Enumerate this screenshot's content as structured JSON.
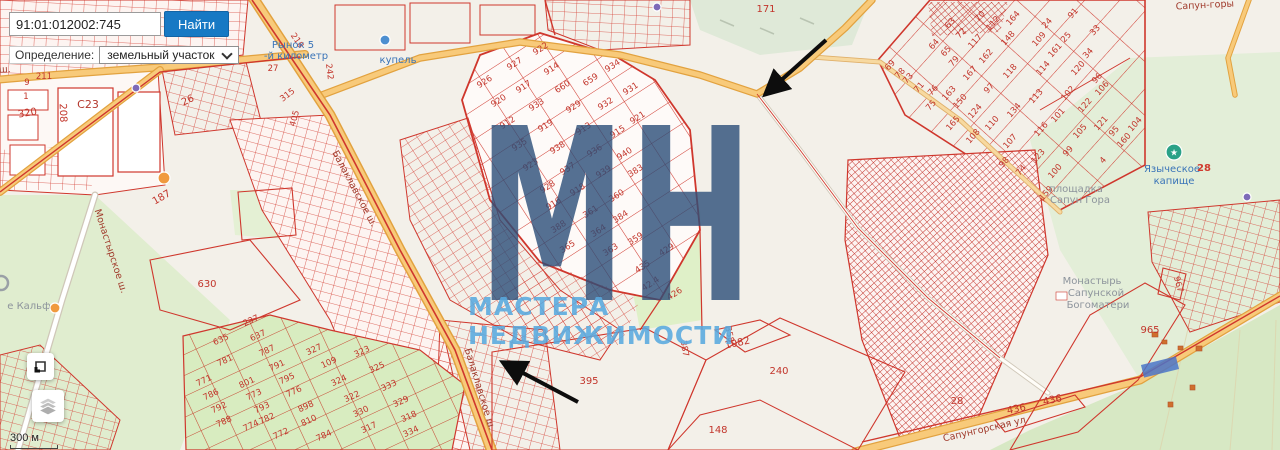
{
  "search": {
    "value": "91:01:012002:745",
    "button_label": "Найти"
  },
  "filter": {
    "label": "Определение:",
    "value": "земельный участок"
  },
  "annotations": {
    "area_label": "10.1 сот.",
    "domino_label": "«Домино»"
  },
  "watermark": {
    "big": "МН",
    "subtitle": "МАСТЕРА НЕДВИЖИМОСТИ"
  },
  "scale_label": "300 м",
  "theme": {
    "accent_blue": "#1779c4",
    "parcel_red": "#d1342c",
    "road_orange": "#f6c87c",
    "green": "#d9ecc0",
    "watermark_blue": "#2a4e78",
    "watermark_light_blue": "#58a8de"
  },
  "map": {
    "parcel_labels": [
      {
        "t": "9",
        "x": 27,
        "y": 85
      },
      {
        "t": "211",
        "x": 44,
        "y": 79
      },
      {
        "t": "1",
        "x": 26,
        "y": 99
      },
      {
        "t": "320",
        "x": 28,
        "y": 116,
        "r": -10,
        "c": "num-lg"
      },
      {
        "t": "208",
        "x": 60,
        "y": 113,
        "r": 88,
        "c": "num-lg"
      },
      {
        "t": "С23",
        "x": 88,
        "y": 108,
        "c": "num-xl"
      },
      {
        "t": "26",
        "x": 189,
        "y": 103,
        "r": -25,
        "c": "num-lg"
      },
      {
        "t": "218",
        "x": 295,
        "y": 42,
        "r": 55
      },
      {
        "t": "242",
        "x": 327,
        "y": 72,
        "r": 83
      },
      {
        "t": "27",
        "x": 273,
        "y": 71
      },
      {
        "t": "315",
        "x": 289,
        "y": 97,
        "r": -38
      },
      {
        "t": "405",
        "x": 297,
        "y": 119,
        "r": -75
      },
      {
        "t": "187",
        "x": 163,
        "y": 200,
        "r": -30,
        "c": "num-lg"
      },
      {
        "t": "630",
        "x": 207,
        "y": 287,
        "c": "num-lg"
      },
      {
        "t": "171",
        "x": 766,
        "y": 12,
        "c": "num-lg"
      },
      {
        "t": "922",
        "x": 542,
        "y": 51,
        "r": -33
      },
      {
        "t": "927",
        "x": 516,
        "y": 66,
        "r": -33
      },
      {
        "t": "914",
        "x": 553,
        "y": 71,
        "r": -33
      },
      {
        "t": "926",
        "x": 486,
        "y": 84,
        "r": -33
      },
      {
        "t": "917",
        "x": 525,
        "y": 89,
        "r": -33
      },
      {
        "t": "660",
        "x": 564,
        "y": 89,
        "r": -33
      },
      {
        "t": "934",
        "x": 614,
        "y": 68,
        "r": -33
      },
      {
        "t": "659",
        "x": 592,
        "y": 82,
        "r": -33
      },
      {
        "t": "931",
        "x": 632,
        "y": 91,
        "r": -33
      },
      {
        "t": "920",
        "x": 500,
        "y": 103,
        "r": -33
      },
      {
        "t": "933",
        "x": 538,
        "y": 107,
        "r": -33
      },
      {
        "t": "929",
        "x": 575,
        "y": 109,
        "r": -33
      },
      {
        "t": "932",
        "x": 607,
        "y": 106,
        "r": -33
      },
      {
        "t": "912",
        "x": 509,
        "y": 125,
        "r": -33
      },
      {
        "t": "919",
        "x": 547,
        "y": 128,
        "r": -33
      },
      {
        "t": "913",
        "x": 585,
        "y": 131,
        "r": -33
      },
      {
        "t": "921",
        "x": 639,
        "y": 120,
        "r": -33
      },
      {
        "t": "915",
        "x": 619,
        "y": 134,
        "r": -33
      },
      {
        "t": "935",
        "x": 521,
        "y": 147,
        "r": -33
      },
      {
        "t": "938",
        "x": 559,
        "y": 150,
        "r": -33
      },
      {
        "t": "936",
        "x": 596,
        "y": 153,
        "r": -33
      },
      {
        "t": "940",
        "x": 626,
        "y": 156,
        "r": -33
      },
      {
        "t": "923",
        "x": 532,
        "y": 167,
        "r": -33
      },
      {
        "t": "937",
        "x": 569,
        "y": 171,
        "r": -33
      },
      {
        "t": "939",
        "x": 605,
        "y": 174,
        "r": -33
      },
      {
        "t": "383",
        "x": 637,
        "y": 173,
        "r": -33
      },
      {
        "t": "928",
        "x": 549,
        "y": 189,
        "r": -33
      },
      {
        "t": "918",
        "x": 579,
        "y": 192,
        "r": -33
      },
      {
        "t": "916",
        "x": 555,
        "y": 206,
        "r": -33
      },
      {
        "t": "360",
        "x": 618,
        "y": 198,
        "r": -33
      },
      {
        "t": "361",
        "x": 592,
        "y": 214,
        "r": -33
      },
      {
        "t": "384",
        "x": 622,
        "y": 219,
        "r": -33
      },
      {
        "t": "364",
        "x": 600,
        "y": 233,
        "r": -33
      },
      {
        "t": "388",
        "x": 560,
        "y": 229,
        "r": -33
      },
      {
        "t": "365",
        "x": 569,
        "y": 249,
        "r": -33
      },
      {
        "t": "363",
        "x": 612,
        "y": 252,
        "r": -33
      },
      {
        "t": "359",
        "x": 637,
        "y": 241,
        "r": -33
      },
      {
        "t": "429",
        "x": 668,
        "y": 252,
        "r": -33
      },
      {
        "t": "435",
        "x": 644,
        "y": 269,
        "r": -33
      },
      {
        "t": "42.4",
        "x": 652,
        "y": 286,
        "r": -33
      },
      {
        "t": "426",
        "x": 676,
        "y": 296,
        "r": -33
      },
      {
        "t": "635",
        "x": 222,
        "y": 342,
        "r": -25
      },
      {
        "t": "637",
        "x": 259,
        "y": 338,
        "r": -25
      },
      {
        "t": "237",
        "x": 252,
        "y": 323,
        "r": -25
      },
      {
        "t": "781",
        "x": 226,
        "y": 363,
        "r": -25
      },
      {
        "t": "787",
        "x": 268,
        "y": 353,
        "r": -25
      },
      {
        "t": "791",
        "x": 278,
        "y": 368,
        "r": -25
      },
      {
        "t": "327",
        "x": 315,
        "y": 352,
        "r": -25
      },
      {
        "t": "323",
        "x": 363,
        "y": 354,
        "r": -25
      },
      {
        "t": "771",
        "x": 205,
        "y": 383,
        "r": -25
      },
      {
        "t": "786",
        "x": 212,
        "y": 397,
        "r": -25
      },
      {
        "t": "801",
        "x": 248,
        "y": 385,
        "r": -25
      },
      {
        "t": "795",
        "x": 288,
        "y": 381,
        "r": -25
      },
      {
        "t": "109",
        "x": 330,
        "y": 365,
        "r": -25
      },
      {
        "t": "325",
        "x": 378,
        "y": 370,
        "r": -25
      },
      {
        "t": "773",
        "x": 255,
        "y": 397,
        "r": -25
      },
      {
        "t": "776",
        "x": 295,
        "y": 394,
        "r": -25
      },
      {
        "t": "324",
        "x": 340,
        "y": 383,
        "r": -25
      },
      {
        "t": "333",
        "x": 390,
        "y": 388,
        "r": -25
      },
      {
        "t": "792",
        "x": 220,
        "y": 410,
        "r": -25
      },
      {
        "t": "793",
        "x": 263,
        "y": 410,
        "r": -25
      },
      {
        "t": "898",
        "x": 307,
        "y": 409,
        "r": -25
      },
      {
        "t": "322",
        "x": 353,
        "y": 399,
        "r": -25
      },
      {
        "t": "329",
        "x": 402,
        "y": 404,
        "r": -25
      },
      {
        "t": "788",
        "x": 225,
        "y": 424,
        "r": -25
      },
      {
        "t": "774",
        "x": 252,
        "y": 428,
        "r": -25
      },
      {
        "t": "782",
        "x": 268,
        "y": 421,
        "r": -25
      },
      {
        "t": "810",
        "x": 310,
        "y": 423,
        "r": -25
      },
      {
        "t": "330",
        "x": 362,
        "y": 414,
        "r": -25
      },
      {
        "t": "318",
        "x": 410,
        "y": 419,
        "r": -25
      },
      {
        "t": "772",
        "x": 282,
        "y": 436,
        "r": -25
      },
      {
        "t": "784",
        "x": 325,
        "y": 438,
        "r": -25
      },
      {
        "t": "317",
        "x": 370,
        "y": 430,
        "r": -25
      },
      {
        "t": "334",
        "x": 412,
        "y": 434,
        "r": -25
      },
      {
        "t": "69",
        "x": 892,
        "y": 67,
        "r": -48
      },
      {
        "t": "78",
        "x": 902,
        "y": 75,
        "r": -48
      },
      {
        "t": "73",
        "x": 910,
        "y": 80,
        "r": -48
      },
      {
        "t": "71",
        "x": 921,
        "y": 89,
        "r": -48
      },
      {
        "t": "76",
        "x": 935,
        "y": 92,
        "r": -48
      },
      {
        "t": "75",
        "x": 933,
        "y": 107,
        "r": -48
      },
      {
        "t": "64",
        "x": 936,
        "y": 46,
        "r": -48
      },
      {
        "t": "65",
        "x": 948,
        "y": 53,
        "r": -48
      },
      {
        "t": "63",
        "x": 952,
        "y": 25,
        "r": -48
      },
      {
        "t": "72",
        "x": 963,
        "y": 35,
        "r": -48
      },
      {
        "t": "79",
        "x": 956,
        "y": 63,
        "r": -48
      },
      {
        "t": "117",
        "x": 977,
        "y": 43,
        "r": -48
      },
      {
        "t": "70",
        "x": 982,
        "y": 18,
        "r": -48
      },
      {
        "t": "112",
        "x": 995,
        "y": 25,
        "r": -48
      },
      {
        "t": "148",
        "x": 1010,
        "y": 40,
        "r": -48
      },
      {
        "t": "164",
        "x": 1015,
        "y": 20,
        "r": -48
      },
      {
        "t": "24",
        "x": 1049,
        "y": 25,
        "r": -48
      },
      {
        "t": "109",
        "x": 1041,
        "y": 41,
        "r": -48
      },
      {
        "t": "161",
        "x": 1057,
        "y": 52,
        "r": -48
      },
      {
        "t": "25",
        "x": 1068,
        "y": 39,
        "r": -48
      },
      {
        "t": "91",
        "x": 1075,
        "y": 15,
        "r": -48
      },
      {
        "t": "33",
        "x": 1097,
        "y": 32,
        "r": -48
      },
      {
        "t": "34",
        "x": 1090,
        "y": 55,
        "r": -48
      },
      {
        "t": "120",
        "x": 1080,
        "y": 70,
        "r": -48
      },
      {
        "t": "96",
        "x": 1099,
        "y": 80,
        "r": -48
      },
      {
        "t": "106",
        "x": 1104,
        "y": 90,
        "r": -48
      },
      {
        "t": "102",
        "x": 1070,
        "y": 95,
        "r": -48
      },
      {
        "t": "162",
        "x": 988,
        "y": 58,
        "r": -48
      },
      {
        "t": "167",
        "x": 972,
        "y": 75,
        "r": -48
      },
      {
        "t": "118",
        "x": 1012,
        "y": 73,
        "r": -48
      },
      {
        "t": "114",
        "x": 1045,
        "y": 70,
        "r": -48
      },
      {
        "t": "113",
        "x": 1038,
        "y": 98,
        "r": -48
      },
      {
        "t": "97",
        "x": 991,
        "y": 90,
        "r": -48
      },
      {
        "t": "163",
        "x": 951,
        "y": 95,
        "r": -48
      },
      {
        "t": "150",
        "x": 962,
        "y": 103,
        "r": -48
      },
      {
        "t": "124",
        "x": 977,
        "y": 113,
        "r": -48
      },
      {
        "t": "110",
        "x": 994,
        "y": 125,
        "r": -48
      },
      {
        "t": "108",
        "x": 975,
        "y": 138,
        "r": -48
      },
      {
        "t": "165",
        "x": 955,
        "y": 125,
        "r": -48
      },
      {
        "t": "134",
        "x": 1016,
        "y": 112,
        "r": -48
      },
      {
        "t": "101",
        "x": 1060,
        "y": 117,
        "r": -48
      },
      {
        "t": "122",
        "x": 1087,
        "y": 107,
        "r": -48
      },
      {
        "t": "121",
        "x": 1103,
        "y": 125,
        "r": -48
      },
      {
        "t": "105",
        "x": 1082,
        "y": 133,
        "r": -48
      },
      {
        "t": "116",
        "x": 1043,
        "y": 131,
        "r": -48
      },
      {
        "t": "107",
        "x": 1012,
        "y": 143,
        "r": -48
      },
      {
        "t": "99",
        "x": 1070,
        "y": 153,
        "r": -48
      },
      {
        "t": "123",
        "x": 1040,
        "y": 158,
        "r": -48
      },
      {
        "t": "100",
        "x": 1057,
        "y": 173,
        "r": -48
      },
      {
        "t": "98",
        "x": 1006,
        "y": 164,
        "r": -48
      },
      {
        "t": "74",
        "x": 1023,
        "y": 172,
        "r": -48
      },
      {
        "t": "159",
        "x": 1048,
        "y": 195,
        "r": -48
      },
      {
        "t": "95",
        "x": 1116,
        "y": 133,
        "r": -48
      },
      {
        "t": "160",
        "x": 1126,
        "y": 142,
        "r": -48
      },
      {
        "t": "104",
        "x": 1137,
        "y": 126,
        "r": -48
      },
      {
        "t": "4",
        "x": 1105,
        "y": 162,
        "r": -48
      },
      {
        "t": "395",
        "x": 589,
        "y": 384,
        "c": "num-lg"
      },
      {
        "t": "240",
        "x": 779,
        "y": 374,
        "c": "num-lg"
      },
      {
        "t": "148",
        "x": 718,
        "y": 433,
        "c": "num-lg"
      },
      {
        "t": "1082",
        "x": 738,
        "y": 346,
        "r": -12,
        "c": "num-lg"
      },
      {
        "t": "358",
        "x": 727,
        "y": 335,
        "r": 78
      },
      {
        "t": "387",
        "x": 682,
        "y": 349,
        "r": 80
      },
      {
        "t": "965",
        "x": 1150,
        "y": 333,
        "c": "num-lg"
      },
      {
        "t": "967",
        "x": 1176,
        "y": 285,
        "r": 75
      },
      {
        "t": "436",
        "x": 1017,
        "y": 412,
        "r": -12,
        "c": "num-lg"
      },
      {
        "t": "436",
        "x": 1053,
        "y": 403,
        "r": -12,
        "c": "num-lg"
      },
      {
        "t": "28",
        "x": 957,
        "y": 404,
        "c": "num-lg"
      }
    ],
    "street_labels": [
      {
        "t": "Камышовое ш.",
        "x": -26,
        "y": 74,
        "r": -3
      },
      {
        "t": "Балаклавское ш.",
        "x": 352,
        "y": 190,
        "r": 62
      },
      {
        "t": "Балаклавское ш.",
        "x": 477,
        "y": 390,
        "r": 73
      },
      {
        "t": "Монастырское ш.",
        "x": 108,
        "y": 252,
        "r": 72
      },
      {
        "t": "Сапунгорская ул",
        "x": 985,
        "y": 432,
        "r": -13
      },
      {
        "t": "Сапун-горы",
        "x": 1205,
        "y": 8,
        "r": -3
      }
    ],
    "poi_labels": [
      {
        "t": "Рынок 5",
        "x": 293,
        "y": 48,
        "c": "poi"
      },
      {
        "t": "-й километр",
        "x": 296,
        "y": 59,
        "c": "poi"
      },
      {
        "t": "купель",
        "x": 398,
        "y": 63,
        "c": "poi"
      },
      {
        "t": "Языческое",
        "x": 1172,
        "y": 172,
        "c": "poi"
      },
      {
        "t": "28",
        "x": 1204,
        "y": 171,
        "c": "red28"
      },
      {
        "t": "капище",
        "x": 1174,
        "y": 184,
        "c": "poi"
      },
      {
        "t": "Монастырь",
        "x": 1092,
        "y": 284,
        "c": "poi-gray"
      },
      {
        "t": "Сапунской",
        "x": 1096,
        "y": 296,
        "c": "poi-gray"
      },
      {
        "t": "Богоматери",
        "x": 1098,
        "y": 308,
        "c": "poi-gray"
      },
      {
        "t": "площадка",
        "x": 1076,
        "y": 192,
        "c": "poi-gray"
      },
      {
        "t": "Сапун Гора",
        "x": 1080,
        "y": 203,
        "c": "poi-gray"
      },
      {
        "t": "е Кальфа",
        "x": 32,
        "y": 309,
        "c": "poi-gray"
      }
    ],
    "markers": [
      {
        "type": "dot",
        "name": "poi-marker-orange-icon",
        "x": 55,
        "y": 308,
        "r": 5,
        "fill": "#f09a3e"
      },
      {
        "type": "dot",
        "name": "poi-marker-orange-icon",
        "x": 164,
        "y": 178,
        "r": 6,
        "fill": "#f09a3e"
      },
      {
        "type": "dot",
        "name": "poi-marker-purple-icon",
        "x": 136,
        "y": 88,
        "r": 4,
        "fill": "#7d6ab8"
      },
      {
        "type": "dot",
        "name": "poi-marker-purple-icon",
        "x": 657,
        "y": 7,
        "r": 4,
        "fill": "#7d6ab8"
      },
      {
        "type": "dot",
        "name": "poi-marker-purple-icon",
        "x": 1247,
        "y": 197,
        "r": 4,
        "fill": "#7d6ab8"
      },
      {
        "type": "dot",
        "name": "poi-marker-blue-icon",
        "x": 385,
        "y": 40,
        "r": 5,
        "fill": "#4d8fd0"
      },
      {
        "type": "star",
        "name": "pagan-site-icon",
        "x": 1174,
        "y": 152,
        "r": 8,
        "fill": "#2aa187"
      },
      {
        "type": "ring",
        "name": "poi-marker-gray-icon",
        "x": 1,
        "y": 283,
        "r": 7,
        "stroke": "#9aa0a6"
      },
      {
        "type": "selrect",
        "name": "selected-parcel-highlight",
        "x": 1160,
        "y": 367,
        "w": 36,
        "h": 13,
        "r": -14,
        "fill": "#4a74c9"
      }
    ]
  }
}
